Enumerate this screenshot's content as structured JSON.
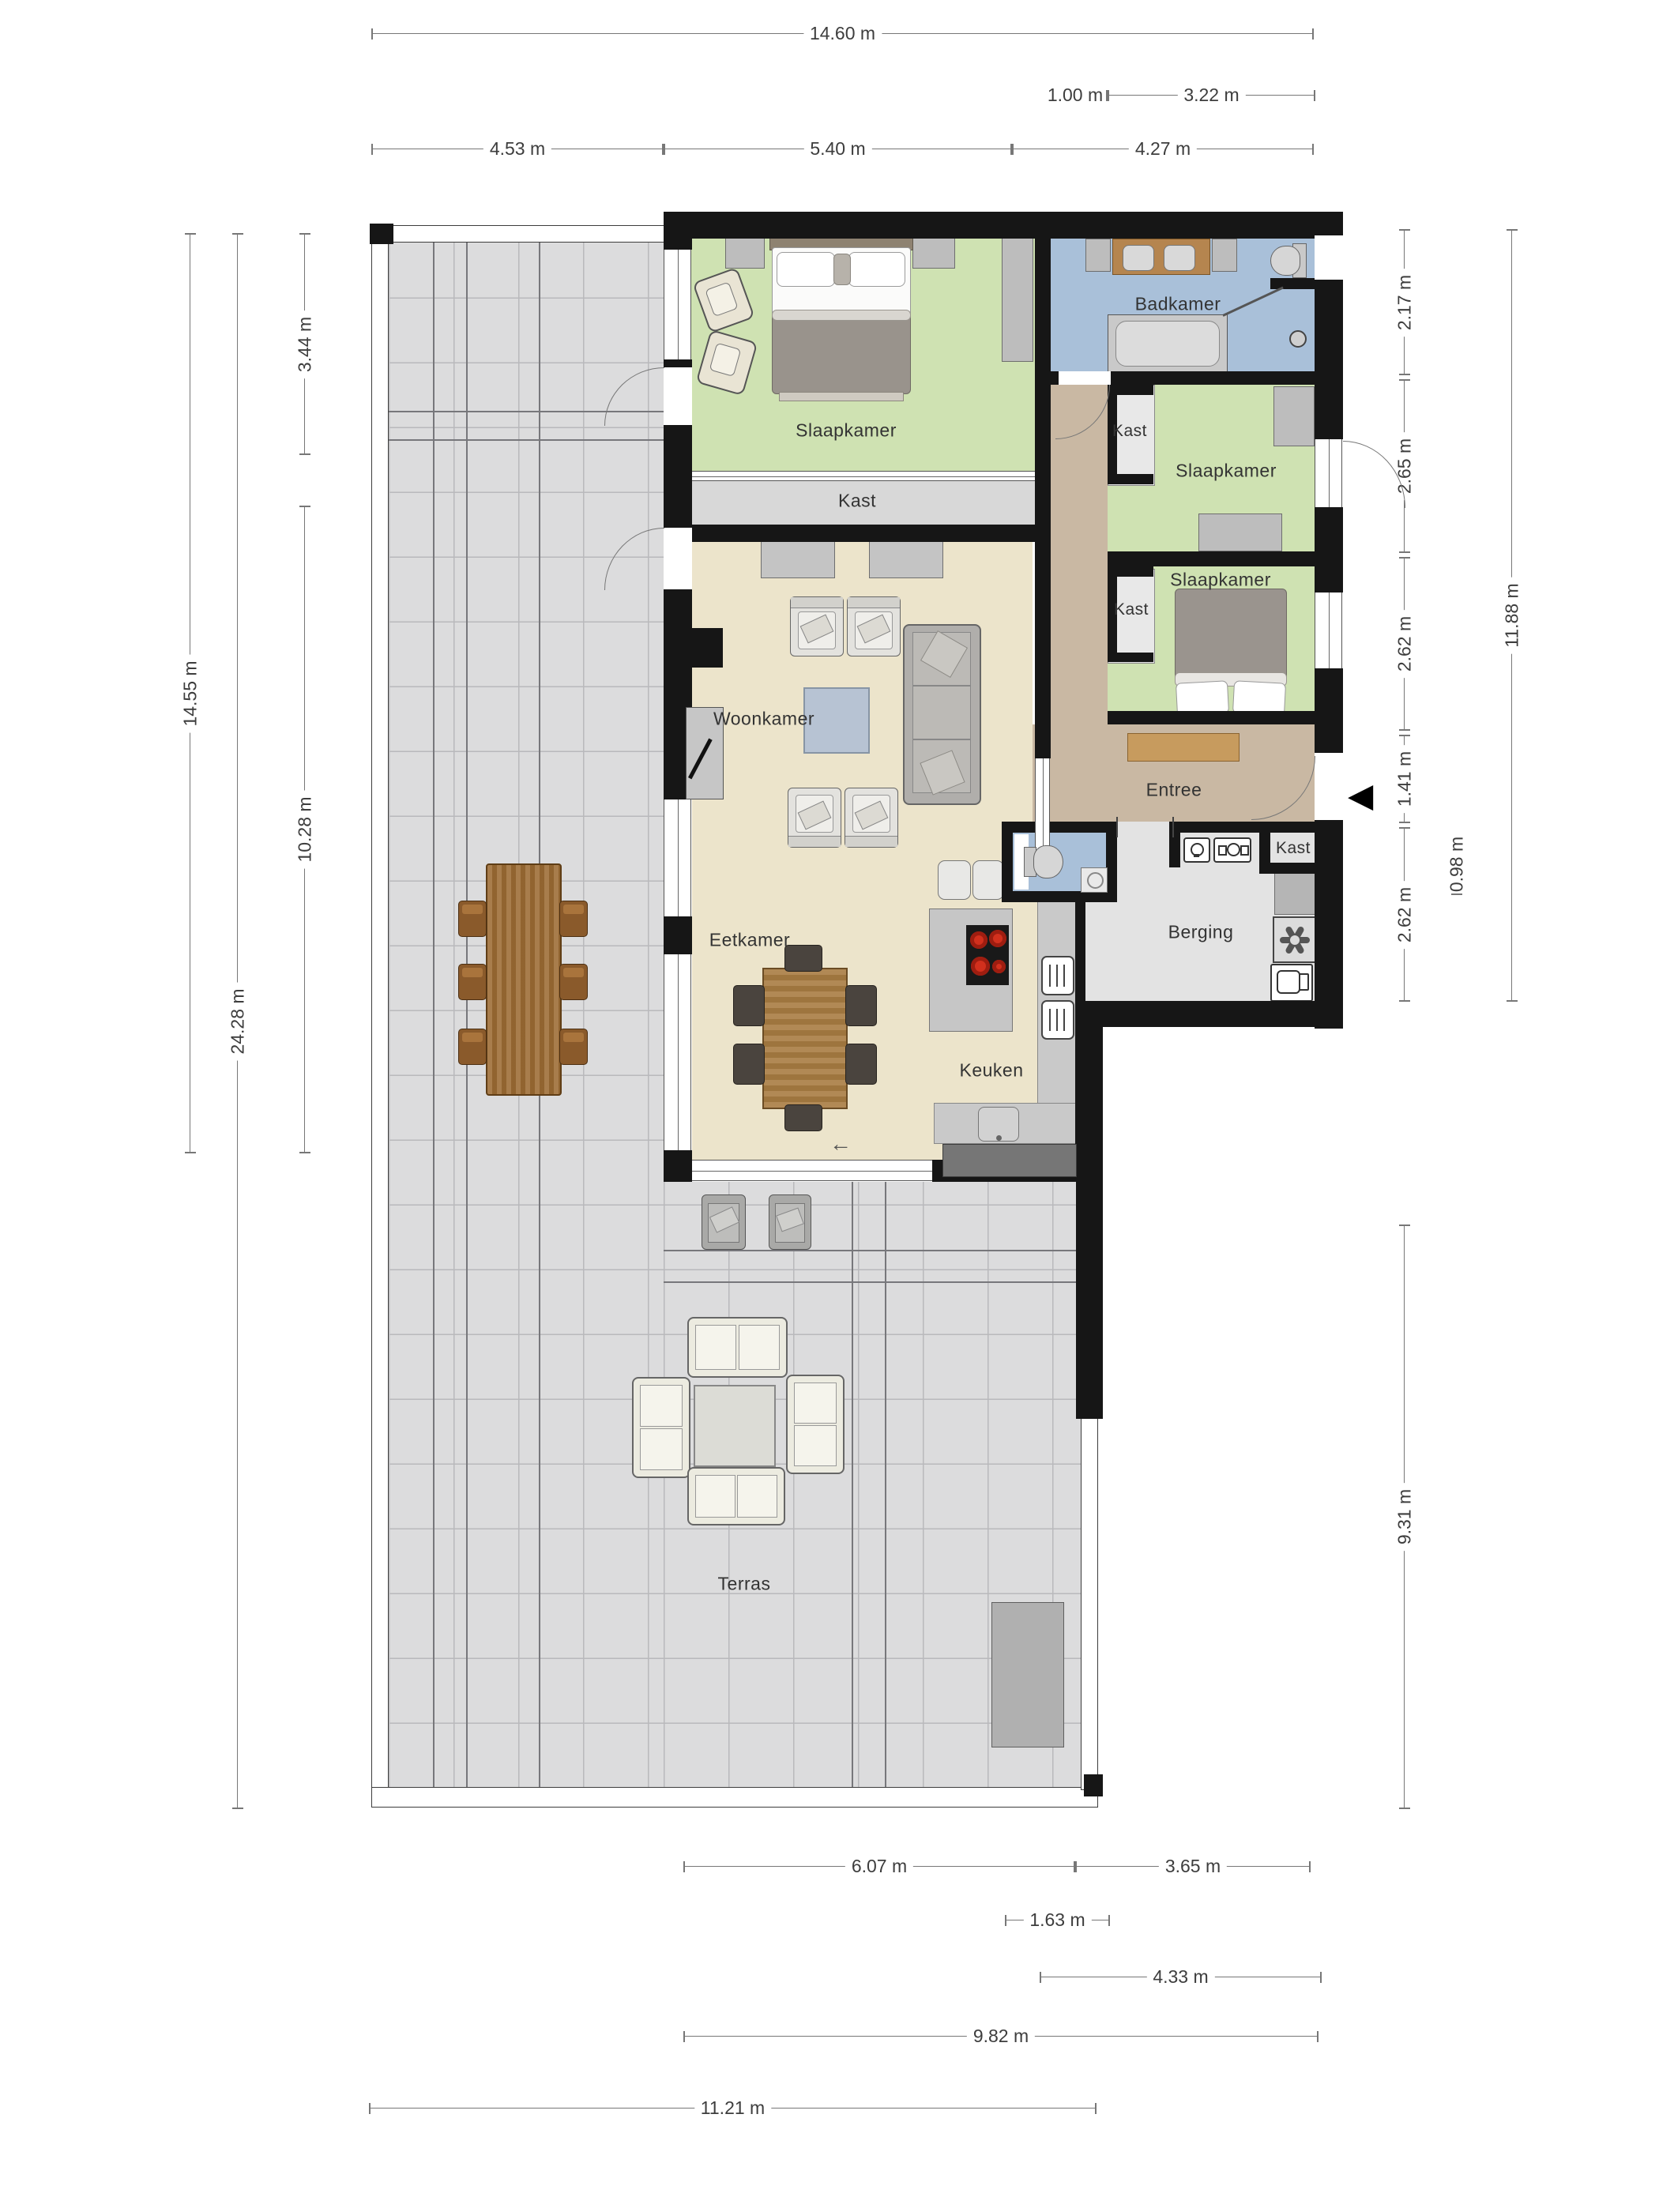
{
  "unit": "m",
  "rooms": [
    {
      "id": "slaapkamer-1",
      "label": "Slaapkamer"
    },
    {
      "id": "kast-strip",
      "label": "Kast"
    },
    {
      "id": "badkamer",
      "label": "Badkamer"
    },
    {
      "id": "kast-2",
      "label": "Kast"
    },
    {
      "id": "slaapkamer-2",
      "label": "Slaapkamer"
    },
    {
      "id": "kast-3",
      "label": "Kast"
    },
    {
      "id": "slaapkamer-3",
      "label": "Slaapkamer"
    },
    {
      "id": "woonkamer",
      "label": "Woonkamer"
    },
    {
      "id": "entree",
      "label": "Entree"
    },
    {
      "id": "kast-4",
      "label": "Kast"
    },
    {
      "id": "berging",
      "label": "Berging"
    },
    {
      "id": "eetkamer",
      "label": "Eetkamer"
    },
    {
      "id": "keuken",
      "label": "Keuken"
    },
    {
      "id": "terras",
      "label": "Terras"
    }
  ],
  "dims": {
    "top": [
      "14.60 m",
      "1.00 m",
      "3.22 m",
      "4.53 m",
      "5.40 m",
      "4.27 m"
    ],
    "left": [
      "3.44 m",
      "14.55 m",
      "10.28 m",
      "24.28 m"
    ],
    "right": [
      "2.17 m",
      "2.65 m",
      "2.62 m",
      "1.41 m",
      "2.62 m",
      "11.88 m",
      "0.98 m",
      "9.31 m"
    ],
    "bottom": [
      "6.07 m",
      "3.65 m",
      "1.63 m",
      "4.33 m",
      "9.82 m",
      "11.21 m"
    ]
  },
  "icons": {
    "entrance_arrow": "◀",
    "slide_arrow": "←"
  },
  "colors": {
    "wall": "#161616",
    "bedroom_green": "#cfe2b2",
    "bathroom_blue": "#a9c0d9",
    "living_cream": "#ece4cb",
    "entree_tan": "#c9b8a3",
    "storage_gray": "#e3e3e3",
    "closet_gray": "#d8d8d8",
    "terrace_gray": "#dcdcdd",
    "wood": "#b5854f",
    "burner_red": "#d2301d",
    "dim_line": "#777777",
    "label_text": "#333333"
  }
}
